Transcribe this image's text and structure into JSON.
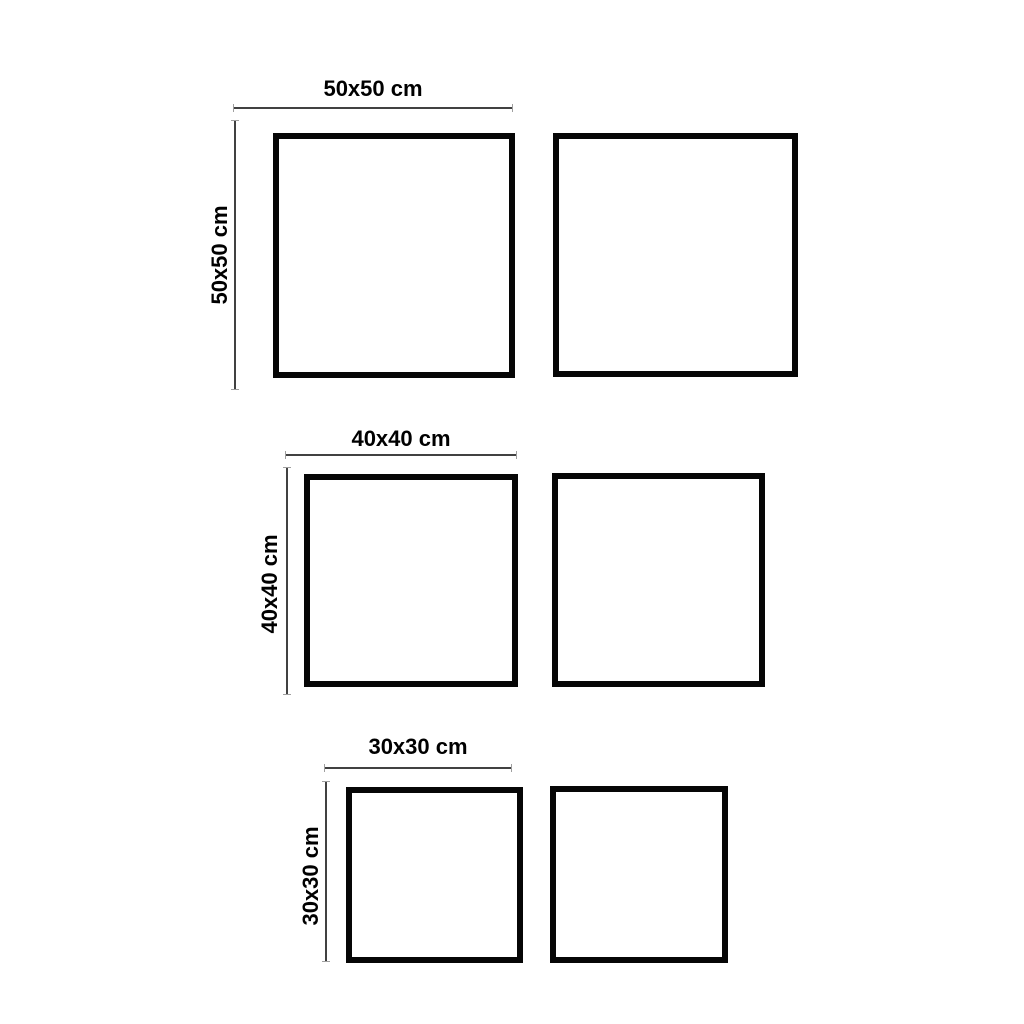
{
  "diagram": {
    "description": "Size comparison diagram of square frames shown in pairs",
    "rows": [
      {
        "size": "50x50",
        "width_label": "50x50 cm",
        "height_label": "50x50 cm",
        "squares": [
          "left",
          "right"
        ]
      },
      {
        "size": "40x40",
        "width_label": "40x40 cm",
        "height_label": "40x40 cm",
        "squares": [
          "left",
          "right"
        ]
      },
      {
        "size": "30x30",
        "width_label": "30x30 cm",
        "height_label": "30x30 cm",
        "squares": [
          "left",
          "right"
        ]
      }
    ],
    "colors": {
      "background": "#ffffff",
      "square_border": "#060606",
      "dimension_line": "#414141",
      "label_text": "#000000"
    }
  }
}
